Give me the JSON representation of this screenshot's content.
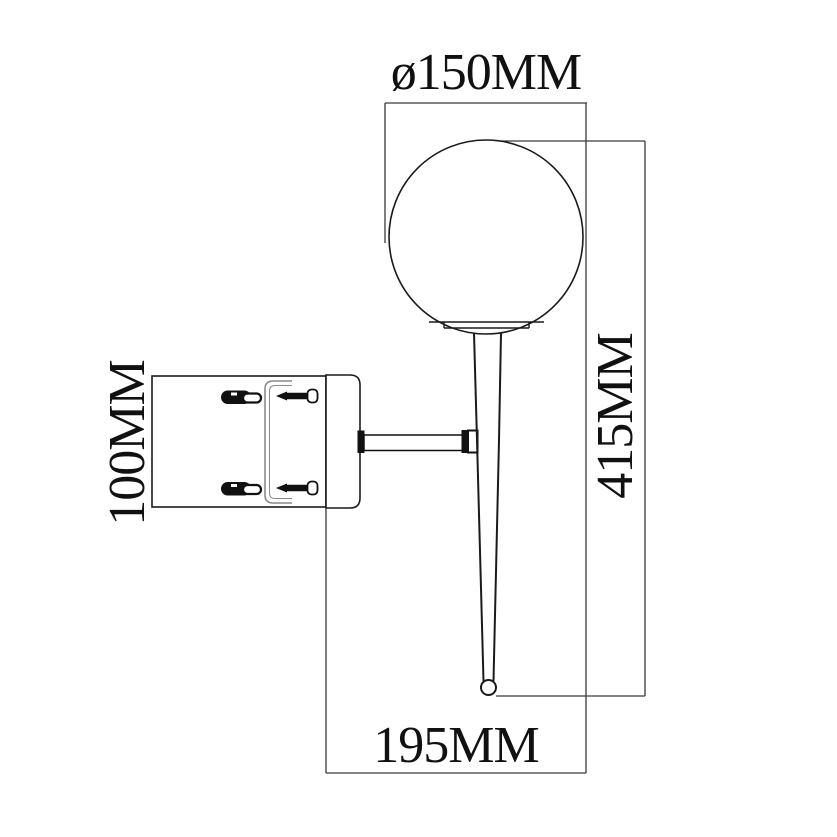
{
  "drawing": {
    "kind": "technical-dimension-drawing",
    "subject": "wall-sconce-globe-lamp",
    "labels": {
      "diameter": "ø150MM",
      "height": "415MM",
      "backplate": "100MM",
      "projection": "195MM"
    },
    "values": {
      "globe_diameter_mm": 150,
      "overall_height_mm": 415,
      "backplate_height_mm": 100,
      "projection_mm": 195
    },
    "colors": {
      "background": "#ffffff",
      "outline": "#1a1a1a",
      "dimension_line": "#3a3a3a",
      "bracket_detail": "#8a8a8a",
      "text": "#111111"
    }
  }
}
